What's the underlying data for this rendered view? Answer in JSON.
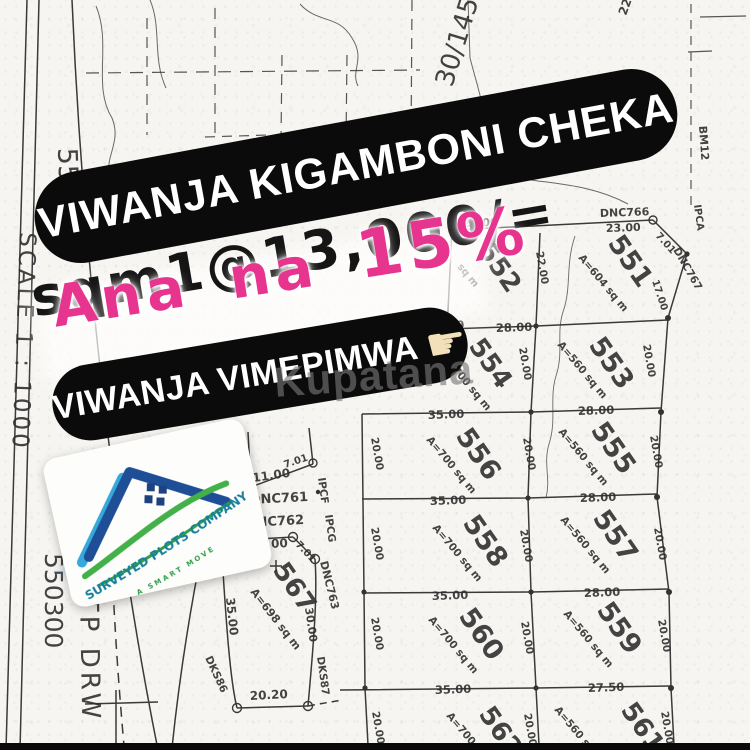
{
  "overlay": {
    "banner1": "VIWANJA KIGAMBONI CHEKA",
    "price_line": "sqm1@13,000/=",
    "discount_prefix": "Ana na",
    "discount_value": "15%",
    "banner2": "VIWANJA VIMEPIMWA",
    "pointer_icon": "☛",
    "watermark": "Kupatana",
    "colors": {
      "pill_bg": "#0b0b0b",
      "pill_text": "#ffffff",
      "accent_pink": "#e6348f",
      "ink": "#151515",
      "finger": "#f1e0ba"
    }
  },
  "logo": {
    "company": "SURVEYED PLOTS COMPANY LTD",
    "tagline": "A SMART MOVE",
    "colors": {
      "teal": "#177f9b",
      "green": "#44b04a",
      "blue_dark": "#1e4e96",
      "blue_light": "#35a8dc"
    }
  },
  "map": {
    "texts": [
      {
        "t": "550200",
        "x": 58,
        "y": 148,
        "r": 88,
        "s": 27,
        "w": 400
      },
      {
        "t": "SCALE 1 : 1000",
        "x": 20,
        "y": 232,
        "r": 92,
        "s": 23,
        "w": 400,
        "ls": 3
      },
      {
        "t": "550300",
        "x": 45,
        "y": 553,
        "r": 90,
        "s": 25,
        "w": 400
      },
      {
        "t": "TP DRW",
        "x": 80,
        "y": 596,
        "r": 89,
        "s": 26,
        "w": 400,
        "ls": 4
      },
      {
        "t": "30/145",
        "x": 452,
        "y": 88,
        "r": -73,
        "s": 26,
        "w": 400
      },
      {
        "t": "22",
        "x": 626,
        "y": 16,
        "r": -70,
        "s": 12
      },
      {
        "t": "BM12",
        "x": 699,
        "y": 126,
        "r": 86,
        "s": 11
      },
      {
        "t": "IPCA",
        "x": 694,
        "y": 205,
        "r": 82,
        "s": 10
      },
      {
        "t": "DNC766",
        "x": 600,
        "y": 217,
        "r": -2,
        "s": 11
      },
      {
        "t": "23.00",
        "x": 606,
        "y": 232,
        "r": -2,
        "s": 11
      },
      {
        "t": "7.01",
        "x": 655,
        "y": 236,
        "r": 48,
        "s": 10
      },
      {
        "t": "DNC767",
        "x": 673,
        "y": 250,
        "r": 60,
        "s": 10.5
      },
      {
        "t": "17.00",
        "x": 652,
        "y": 281,
        "r": 72,
        "s": 10
      },
      {
        "t": "22.00",
        "x": 463,
        "y": 227,
        "r": -2,
        "s": 11
      },
      {
        "t": "552",
        "x": 477,
        "y": 250,
        "r": 55,
        "s": 26
      },
      {
        "t": "sq m",
        "x": 457,
        "y": 267,
        "r": 50,
        "s": 10
      },
      {
        "t": "551",
        "x": 607,
        "y": 243,
        "r": 55,
        "s": 27
      },
      {
        "t": "A=604 sq m",
        "x": 578,
        "y": 258,
        "r": 50,
        "s": 10.5
      },
      {
        "t": "22.00",
        "x": 536,
        "y": 252,
        "r": 80,
        "s": 10.5
      },
      {
        "t": "20.00",
        "x": 643,
        "y": 345,
        "r": 80,
        "s": 10.5
      },
      {
        "t": "28.00",
        "x": 496,
        "y": 332,
        "r": -2,
        "s": 11.5
      },
      {
        "t": "35.00",
        "x": 428,
        "y": 330,
        "r": -2,
        "s": 11.5
      },
      {
        "t": "554",
        "x": 468,
        "y": 346,
        "r": 55,
        "s": 26
      },
      {
        "t": "A=700 sq m",
        "x": 441,
        "y": 357,
        "r": 50,
        "s": 10.5
      },
      {
        "t": "553",
        "x": 588,
        "y": 345,
        "r": 55,
        "s": 27
      },
      {
        "t": "A=560 sq m",
        "x": 557,
        "y": 345,
        "r": 50,
        "s": 10.5
      },
      {
        "t": "20.00",
        "x": 519,
        "y": 348,
        "r": 80,
        "s": 10.5
      },
      {
        "t": "35.00",
        "x": 428,
        "y": 419,
        "r": -2,
        "s": 11.5
      },
      {
        "t": "28.00",
        "x": 578,
        "y": 415,
        "r": -2,
        "s": 11.5
      },
      {
        "t": "556",
        "x": 455,
        "y": 436,
        "r": 55,
        "s": 27
      },
      {
        "t": "A=700 sq m",
        "x": 426,
        "y": 440,
        "r": 50,
        "s": 10.5
      },
      {
        "t": "555",
        "x": 590,
        "y": 430,
        "r": 55,
        "s": 27
      },
      {
        "t": "A=560 sq m",
        "x": 558,
        "y": 432,
        "r": 50,
        "s": 10.5
      },
      {
        "t": "20.00",
        "x": 523,
        "y": 438,
        "r": 80,
        "s": 10.5
      },
      {
        "t": "20.00",
        "x": 650,
        "y": 436,
        "r": 80,
        "s": 10.5
      },
      {
        "t": "20.00",
        "x": 371,
        "y": 438,
        "r": 80,
        "s": 10.5
      },
      {
        "t": "35.00",
        "x": 430,
        "y": 505,
        "r": -2,
        "s": 11.5
      },
      {
        "t": "28.00",
        "x": 580,
        "y": 502,
        "r": -2,
        "s": 11.5
      },
      {
        "t": "558",
        "x": 462,
        "y": 523,
        "r": 55,
        "s": 27
      },
      {
        "t": "A=700 sq m",
        "x": 432,
        "y": 528,
        "r": 50,
        "s": 10.5
      },
      {
        "t": "557",
        "x": 592,
        "y": 518,
        "r": 55,
        "s": 27
      },
      {
        "t": "A=560 sq m",
        "x": 560,
        "y": 520,
        "r": 50,
        "s": 10.5
      },
      {
        "t": "20.00",
        "x": 520,
        "y": 530,
        "r": 80,
        "s": 10.5
      },
      {
        "t": "20.00",
        "x": 654,
        "y": 528,
        "r": 80,
        "s": 10.5
      },
      {
        "t": "20.00",
        "x": 371,
        "y": 528,
        "r": 80,
        "s": 10.5
      },
      {
        "t": "35.00",
        "x": 432,
        "y": 600,
        "r": -2,
        "s": 11.5
      },
      {
        "t": "28.00",
        "x": 584,
        "y": 597,
        "r": -2,
        "s": 11.5
      },
      {
        "t": "560",
        "x": 458,
        "y": 616,
        "r": 55,
        "s": 27
      },
      {
        "t": "A=700 sq m",
        "x": 428,
        "y": 620,
        "r": 50,
        "s": 10.5
      },
      {
        "t": "559",
        "x": 596,
        "y": 610,
        "r": 55,
        "s": 27
      },
      {
        "t": "A=560 sq m",
        "x": 563,
        "y": 614,
        "r": 50,
        "s": 10.5
      },
      {
        "t": "20.00",
        "x": 521,
        "y": 622,
        "r": 80,
        "s": 10.5
      },
      {
        "t": "20.00",
        "x": 658,
        "y": 620,
        "r": 80,
        "s": 10.5
      },
      {
        "t": "20.00",
        "x": 371,
        "y": 618,
        "r": 80,
        "s": 10.5
      },
      {
        "t": "35.00",
        "x": 435,
        "y": 694,
        "r": -2,
        "s": 11.5
      },
      {
        "t": "27.50",
        "x": 588,
        "y": 692,
        "r": -2,
        "s": 11.5
      },
      {
        "t": "562",
        "x": 478,
        "y": 714,
        "r": 55,
        "s": 26
      },
      {
        "t": "A=700 sq m",
        "x": 446,
        "y": 716,
        "r": 50,
        "s": 10.5
      },
      {
        "t": "561",
        "x": 620,
        "y": 710,
        "r": 55,
        "s": 26
      },
      {
        "t": "A=560 sq m",
        "x": 554,
        "y": 710,
        "r": 50,
        "s": 10.5
      },
      {
        "t": "20.00",
        "x": 524,
        "y": 714,
        "r": 80,
        "s": 10.5
      },
      {
        "t": "20.00",
        "x": 661,
        "y": 712,
        "r": 80,
        "s": 10.5
      },
      {
        "t": "20.00",
        "x": 372,
        "y": 712,
        "r": 80,
        "s": 10.5
      },
      {
        "t": "DKS82",
        "x": 236,
        "y": 446,
        "r": 78,
        "s": 10.5
      },
      {
        "t": "11.00",
        "x": 253,
        "y": 482,
        "r": -8,
        "s": 12
      },
      {
        "t": "DNC761",
        "x": 250,
        "y": 504,
        "r": -3,
        "s": 13
      },
      {
        "t": "IPCF",
        "x": 318,
        "y": 478,
        "r": 82,
        "s": 10.5
      },
      {
        "t": "7.01",
        "x": 285,
        "y": 468,
        "r": -18,
        "s": 10
      },
      {
        "t": "DNC762",
        "x": 246,
        "y": 527,
        "r": -3,
        "s": 13
      },
      {
        "t": "15.00",
        "x": 250,
        "y": 549,
        "r": -3,
        "s": 12
      },
      {
        "t": "7.01",
        "x": 295,
        "y": 545,
        "r": 46,
        "s": 10
      },
      {
        "t": "IPCG",
        "x": 325,
        "y": 515,
        "r": 82,
        "s": 10.5
      },
      {
        "t": "DNC763",
        "x": 320,
        "y": 562,
        "r": 76,
        "s": 11
      },
      {
        "t": "DKS65",
        "x": 207,
        "y": 540,
        "r": 70,
        "s": 10.5
      },
      {
        "t": "35.00",
        "x": 226,
        "y": 598,
        "r": 84,
        "s": 12
      },
      {
        "t": "567",
        "x": 272,
        "y": 570,
        "r": 55,
        "s": 26
      },
      {
        "t": "A=698 sq m",
        "x": 250,
        "y": 592,
        "r": 52,
        "s": 11
      },
      {
        "t": "30.00",
        "x": 305,
        "y": 608,
        "r": 82,
        "s": 11
      },
      {
        "t": "DKS86",
        "x": 205,
        "y": 658,
        "r": 65,
        "s": 10.5
      },
      {
        "t": "20.20",
        "x": 250,
        "y": 700,
        "r": -3,
        "s": 12
      },
      {
        "t": "DKS87",
        "x": 317,
        "y": 657,
        "r": 82,
        "s": 10.5
      }
    ]
  }
}
